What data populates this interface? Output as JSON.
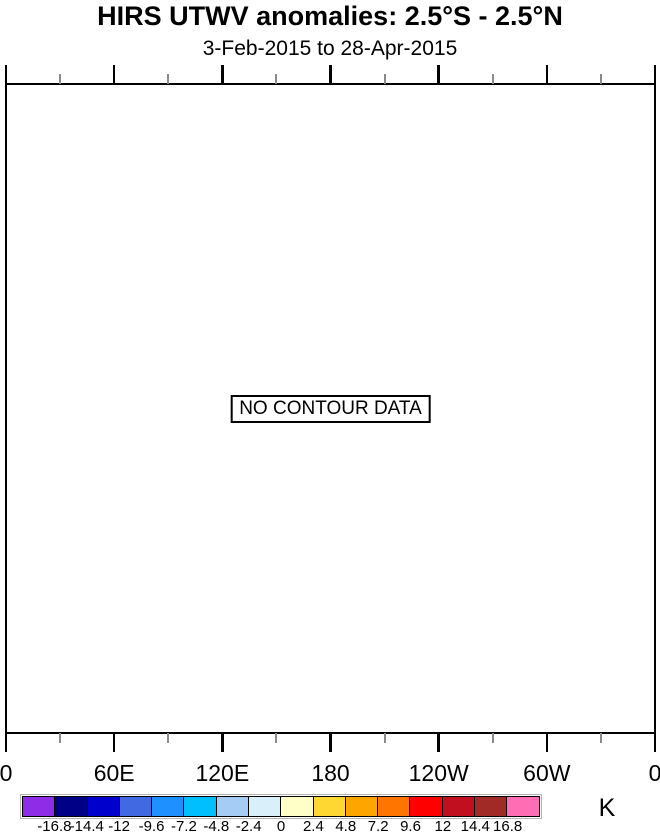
{
  "title": "HIRS UTWV anomalies: 2.5°S - 2.5°N",
  "subtitle": "3-Feb-2015 to 28-Apr-2015",
  "plot": {
    "no_data_label": "NO CONTOUR DATA",
    "background": "#ffffff",
    "frame_color": "#000000",
    "minor_tick_color": "#8a8a8a",
    "x_axis": {
      "tick_labels": [
        "0",
        "60E",
        "120E",
        "180",
        "120W",
        "60W",
        "0"
      ],
      "major_ticks_deg": [
        0,
        60,
        120,
        180,
        240,
        300,
        360
      ],
      "minor_ticks_deg": [
        30,
        90,
        150,
        210,
        270,
        330
      ]
    }
  },
  "colorbar": {
    "unit_label": "K",
    "boundary_labels": [
      "-16.8",
      "-14.4",
      "-12",
      "-9.6",
      "-7.2",
      "-4.8",
      "-2.4",
      "0",
      "2.4",
      "4.8",
      "7.2",
      "9.6",
      "12",
      "14.4",
      "16.8"
    ],
    "cell_colors": [
      "#8e2ce8",
      "#000087",
      "#0000cd",
      "#4169e1",
      "#1e90ff",
      "#00bfff",
      "#a5ccf5",
      "#d9effa",
      "#ffffc8",
      "#ffd732",
      "#ffa500",
      "#ff7500",
      "#ff0000",
      "#c10f20",
      "#a12a26",
      "#ff6eb4"
    ]
  },
  "chart_data": {
    "type": "heatmap",
    "title": "HIRS UTWV anomalies: 2.5°S - 2.5°N",
    "subtitle": "3-Feb-2015 to 28-Apr-2015",
    "annotation": "NO CONTOUR DATA",
    "values": [],
    "x_tick_labels": [
      "0",
      "60E",
      "120E",
      "180",
      "120W",
      "60W",
      "0"
    ],
    "x_range_deg": [
      0,
      360
    ],
    "grid": false,
    "legend_position": "bottom",
    "colorbar_unit": "K",
    "colorbar_levels": [
      -16.8,
      -14.4,
      -12,
      -9.6,
      -7.2,
      -4.8,
      -2.4,
      0,
      2.4,
      4.8,
      7.2,
      9.6,
      12,
      14.4,
      16.8
    ]
  }
}
